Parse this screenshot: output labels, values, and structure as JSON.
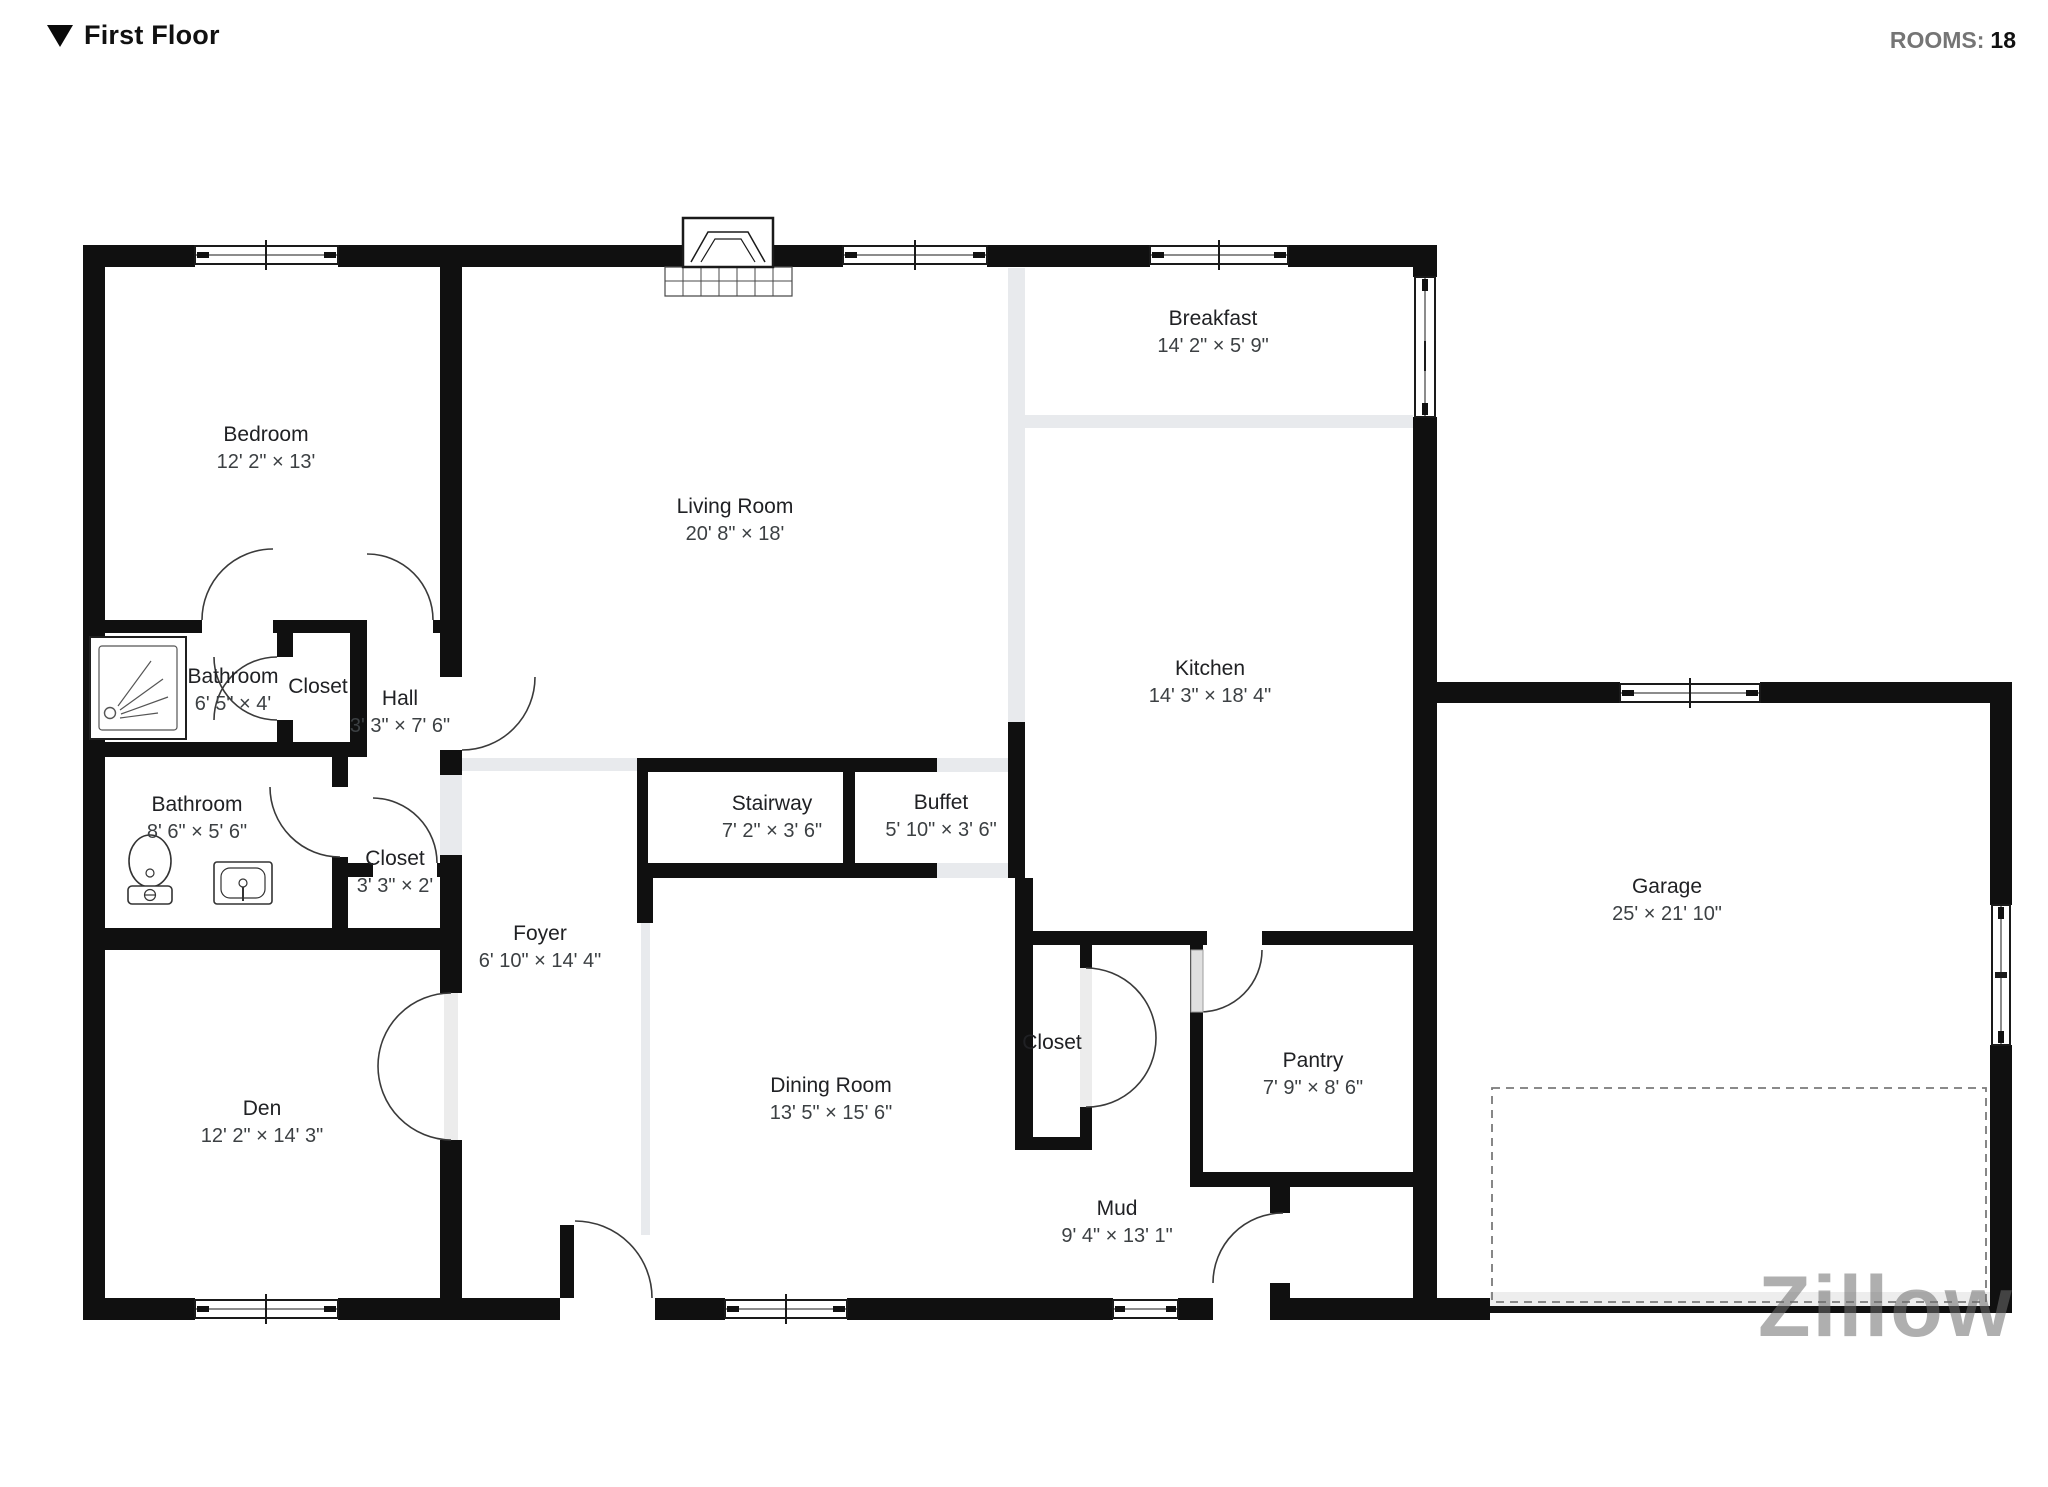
{
  "header": {
    "title": "First Floor",
    "rooms_label": "ROOMS:",
    "rooms_value": "18"
  },
  "watermark": {
    "text": "Zillow"
  },
  "rooms": [
    {
      "id": "bedroom",
      "name": "Bedroom",
      "dims": "12' 2\" × 13'",
      "cx": 266,
      "cy": 448
    },
    {
      "id": "living-room",
      "name": "Living Room",
      "dims": "20' 8\" × 18'",
      "cx": 735,
      "cy": 520
    },
    {
      "id": "breakfast",
      "name": "Breakfast",
      "dims": "14' 2\" × 5' 9\"",
      "cx": 1213,
      "cy": 332
    },
    {
      "id": "kitchen",
      "name": "Kitchen",
      "dims": "14' 3\" × 18' 4\"",
      "cx": 1210,
      "cy": 682
    },
    {
      "id": "bathroom-small",
      "name": "Bathroom",
      "dims": "6' 5\" × 4'",
      "cx": 233,
      "cy": 690
    },
    {
      "id": "closet-hall",
      "name": "Closet",
      "dims": "",
      "cx": 318,
      "cy": 687
    },
    {
      "id": "hall",
      "name": "Hall",
      "dims": "3' 3\" × 7' 6\"",
      "cx": 400,
      "cy": 712
    },
    {
      "id": "bathroom-main",
      "name": "Bathroom",
      "dims": "8' 6\" × 5' 6\"",
      "cx": 197,
      "cy": 818
    },
    {
      "id": "closet-foyer",
      "name": "Closet",
      "dims": "3' 3\" × 2'",
      "cx": 395,
      "cy": 872
    },
    {
      "id": "stairway",
      "name": "Stairway",
      "dims": "7' 2\" × 3' 6\"",
      "cx": 772,
      "cy": 817
    },
    {
      "id": "buffet",
      "name": "Buffet",
      "dims": "5' 10\" × 3' 6\"",
      "cx": 941,
      "cy": 816
    },
    {
      "id": "foyer",
      "name": "Foyer",
      "dims": "6' 10\" × 14' 4\"",
      "cx": 540,
      "cy": 947
    },
    {
      "id": "den",
      "name": "Den",
      "dims": "12' 2\" × 14' 3\"",
      "cx": 262,
      "cy": 1122
    },
    {
      "id": "dining-room",
      "name": "Dining Room",
      "dims": "13' 5\" × 15' 6\"",
      "cx": 831,
      "cy": 1099
    },
    {
      "id": "closet-mud",
      "name": "Closet",
      "dims": "",
      "cx": 1052,
      "cy": 1043
    },
    {
      "id": "pantry",
      "name": "Pantry",
      "dims": "7' 9\" × 8' 6\"",
      "cx": 1313,
      "cy": 1074
    },
    {
      "id": "mud",
      "name": "Mud",
      "dims": "9' 4\" × 13' 1\"",
      "cx": 1117,
      "cy": 1222
    },
    {
      "id": "garage",
      "name": "Garage",
      "dims": "25' × 21' 10\"",
      "cx": 1667,
      "cy": 900
    }
  ]
}
